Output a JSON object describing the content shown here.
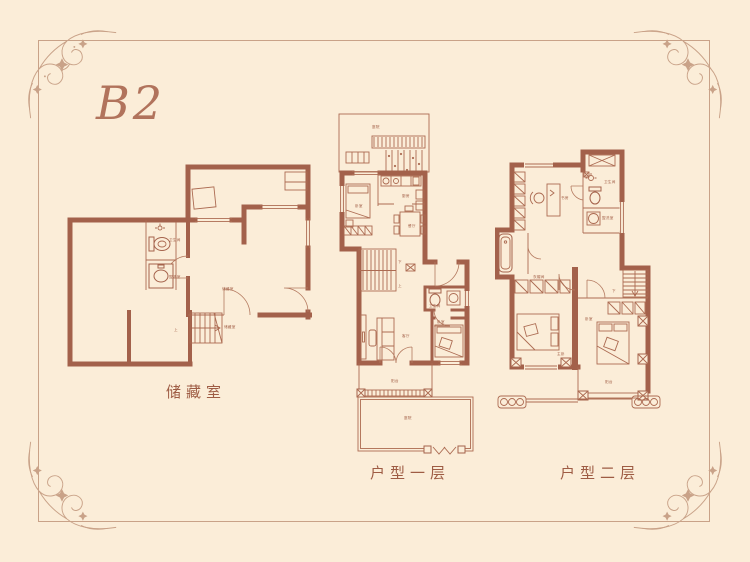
{
  "page": {
    "unit_label": "B2"
  },
  "colors": {
    "background": "#FBEDD8",
    "frame": "#C9A288",
    "wall": "#A3614B",
    "thin_line": "#AC6B52",
    "caption_text": "#9E5C44",
    "unit_label_text": "#B1735C"
  },
  "plans": {
    "basement": {
      "caption": "储藏室",
      "rooms": {
        "bathroom": "卫生间",
        "washroom": "盥洗室",
        "storage1": "储藏室",
        "storage2": "储藏室",
        "stairs_up": "上"
      }
    },
    "floor1": {
      "caption": "户型一层",
      "rooms": {
        "courtyard": "庭院",
        "bedroom": "卧室",
        "kitchen": "厨房",
        "dining": "餐厅",
        "stairs_down": "下",
        "stairs_up": "上",
        "living": "客厅",
        "bathroom": "卫生间",
        "bedroom2": "卧室",
        "balcony": "阳台",
        "courtyard2": "庭院"
      }
    },
    "floor2": {
      "caption": "户型二层",
      "rooms": {
        "study": "书房",
        "bathroom": "卫生间",
        "washroom": "盥洗室",
        "closet": "衣帽间",
        "master": "主卧",
        "bedroom": "卧室",
        "stairs_down": "下",
        "balcony": "阳台"
      }
    }
  }
}
